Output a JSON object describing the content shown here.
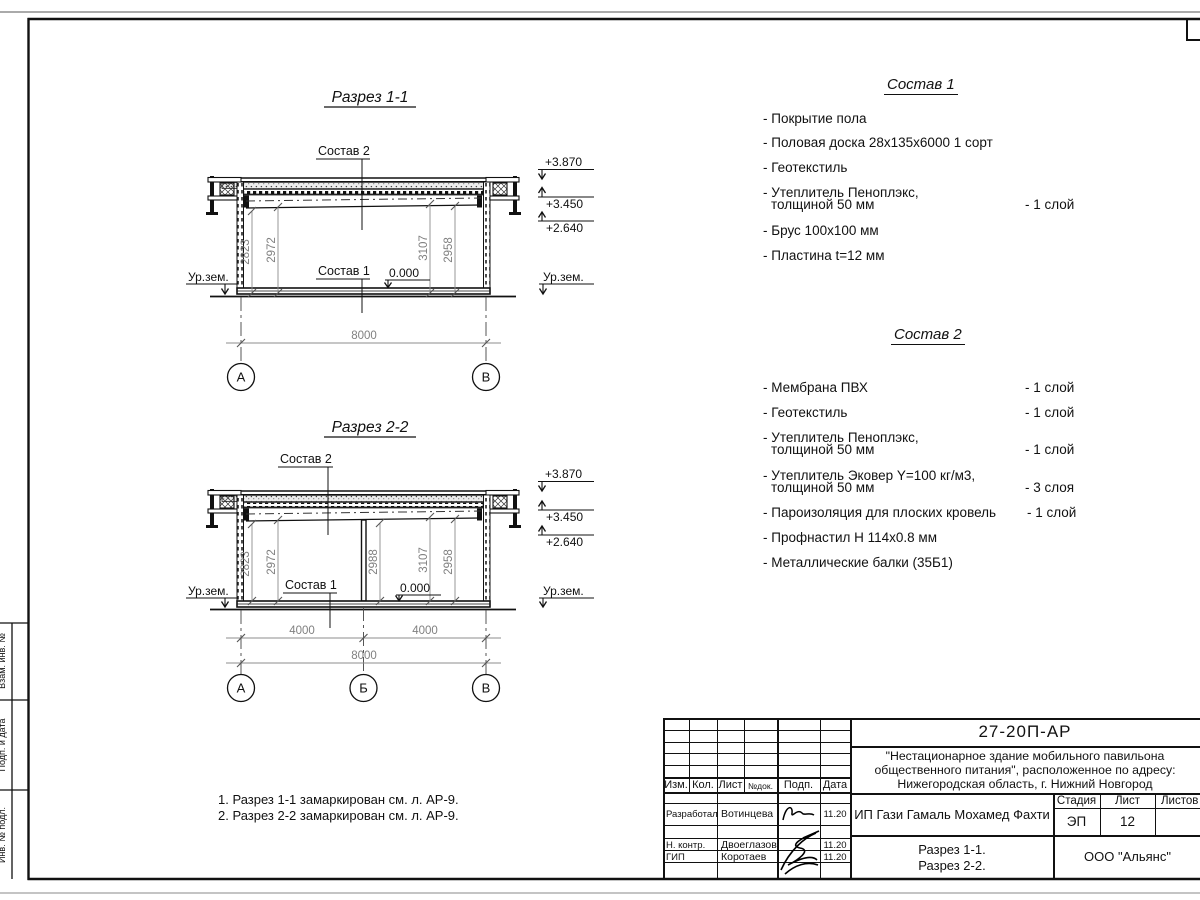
{
  "section1": {
    "title": "Разрез 1-1",
    "sostav2_label": "Состав 2",
    "sostav1_label": "Состав 1",
    "zero": "0.000",
    "ground_left": "Ур.зем.",
    "ground_right": "Ур.зем.",
    "elev": [
      "+3.870",
      "+3.450",
      "+2.640"
    ],
    "dims": [
      "2823",
      "2972",
      "3107",
      "2958"
    ],
    "total": "8000",
    "axes": [
      "А",
      "В"
    ]
  },
  "section2": {
    "title": "Разрез 2-2",
    "sostav2_label": "Состав 2",
    "sostav1_label": "Состав 1",
    "zero": "0.000",
    "ground_left": "Ур.зем.",
    "ground_right": "Ур.зем.",
    "elev": [
      "+3.870",
      "+3.450",
      "+2.640"
    ],
    "dims": [
      "2823",
      "2972",
      "2988",
      "3107",
      "2958"
    ],
    "span_dims": [
      "4000",
      "4000"
    ],
    "total": "8000",
    "axes": [
      "А",
      "Б",
      "В"
    ]
  },
  "sostav1": {
    "title": "Состав 1",
    "items": [
      {
        "name": "- Покрытие пола"
      },
      {
        "name": "- Половая доска 28х135х6000 1 сорт"
      },
      {
        "name": "- Геотекстиль"
      },
      {
        "name": "- Утеплитель Пеноплэкс,",
        "name2": "толщиной 50 мм",
        "qty": "- 1 слой"
      },
      {
        "name": "- Брус 100х100 мм"
      },
      {
        "name": "- Пластина t=12 мм"
      }
    ]
  },
  "sostav2": {
    "title": "Состав 2",
    "items": [
      {
        "name": "- Мембрана ПВХ",
        "qty": "- 1 слой"
      },
      {
        "name": "- Геотекстиль",
        "qty": "- 1 слой"
      },
      {
        "name": "- Утеплитель Пеноплэкс,",
        "name2": "толщиной 50 мм",
        "qty": "- 1 слой"
      },
      {
        "name": "- Утеплитель Эковер Y=100 кг/м3,",
        "name2": "толщиной 50 мм",
        "qty": "- 3 слоя"
      },
      {
        "name": "- Пароизоляция для плоских кровель",
        "qty": "- 1 слой"
      },
      {
        "name": "- Профнастил Н 114х0.8 мм"
      },
      {
        "name": "- Металлические балки (35Б1)"
      }
    ]
  },
  "notes": [
    "1. Разрез 1-1 замаркирован см. л. АР-9.",
    "2. Разрез 2-2 замаркирован см. л. АР-9."
  ],
  "margin_labels": [
    "Взам. инв. №",
    "Подп. и дата",
    "Инв. № подл."
  ],
  "titleblock": {
    "doc_code": "27-20П-АР",
    "project": [
      "\"Нестационарное здание мобильного павильона",
      "общественного питания\", расположенное по адресу:",
      "Нижегородская область, г. Нижний Новгород"
    ],
    "header_cols": [
      "Изм.",
      "Кол.",
      "Лист",
      "№док.",
      "Подп.",
      "Дата"
    ],
    "rows": [
      {
        "role": "Разработал",
        "name": "Вотинцева",
        "date": "11.20"
      },
      {
        "role": "Н. контр.",
        "name": "Двоеглазов",
        "date": "11.20"
      },
      {
        "role": "ГИП",
        "name": "Коротаев",
        "date": "11.20"
      }
    ],
    "client": "ИП Гази Гамаль Мохамед Фахти",
    "stage_label": "Стадия",
    "sheet_label": "Лист",
    "sheets_label": "Листов",
    "stage": "ЭП",
    "sheet": "12",
    "sheet_title": [
      "Разрез 1-1.",
      "Разрез 2-2."
    ],
    "org": "ООО \"Альянс\""
  }
}
